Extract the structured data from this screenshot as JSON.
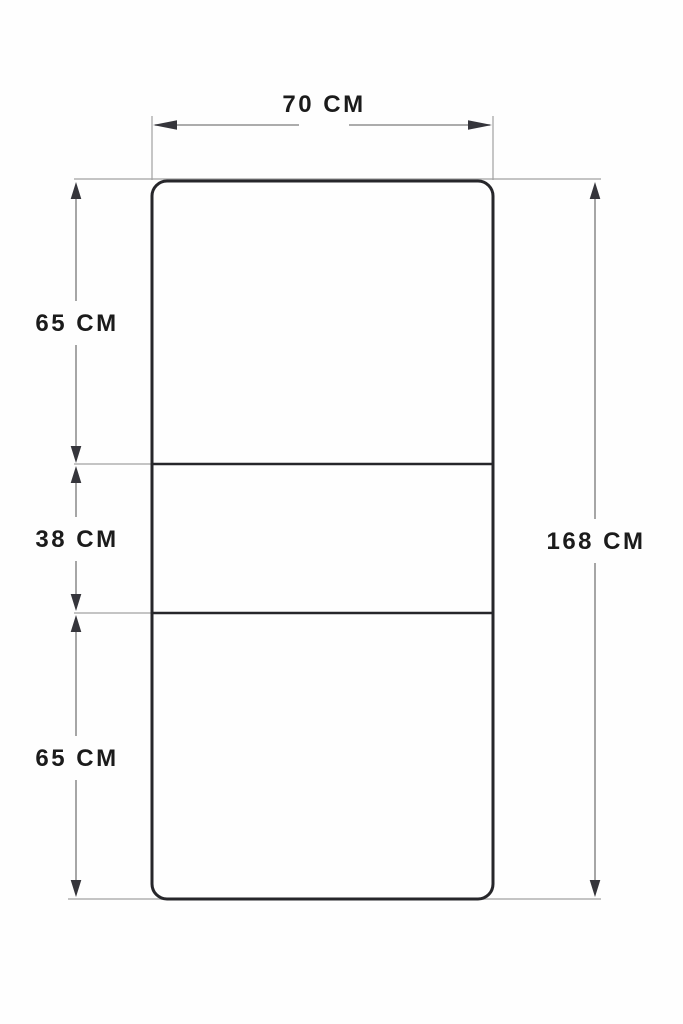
{
  "diagram": {
    "type": "dimension-drawing",
    "unit": "CM",
    "colors": {
      "background": "#fefefe",
      "outline": "#26262a",
      "dimension_lines": "#909090",
      "extension_lines": "#a2a2a2",
      "arrowheads": "#35353b",
      "label_text": "#1b1b1b"
    },
    "dimensions": {
      "width": {
        "label": "70 CM",
        "value_cm": 70
      },
      "total_height": {
        "label": "168 CM",
        "value_cm": 168
      },
      "sections": [
        {
          "label": "65 CM",
          "value_cm": 65
        },
        {
          "label": "38 CM",
          "value_cm": 38
        },
        {
          "label": "65 CM",
          "value_cm": 65
        }
      ]
    }
  }
}
